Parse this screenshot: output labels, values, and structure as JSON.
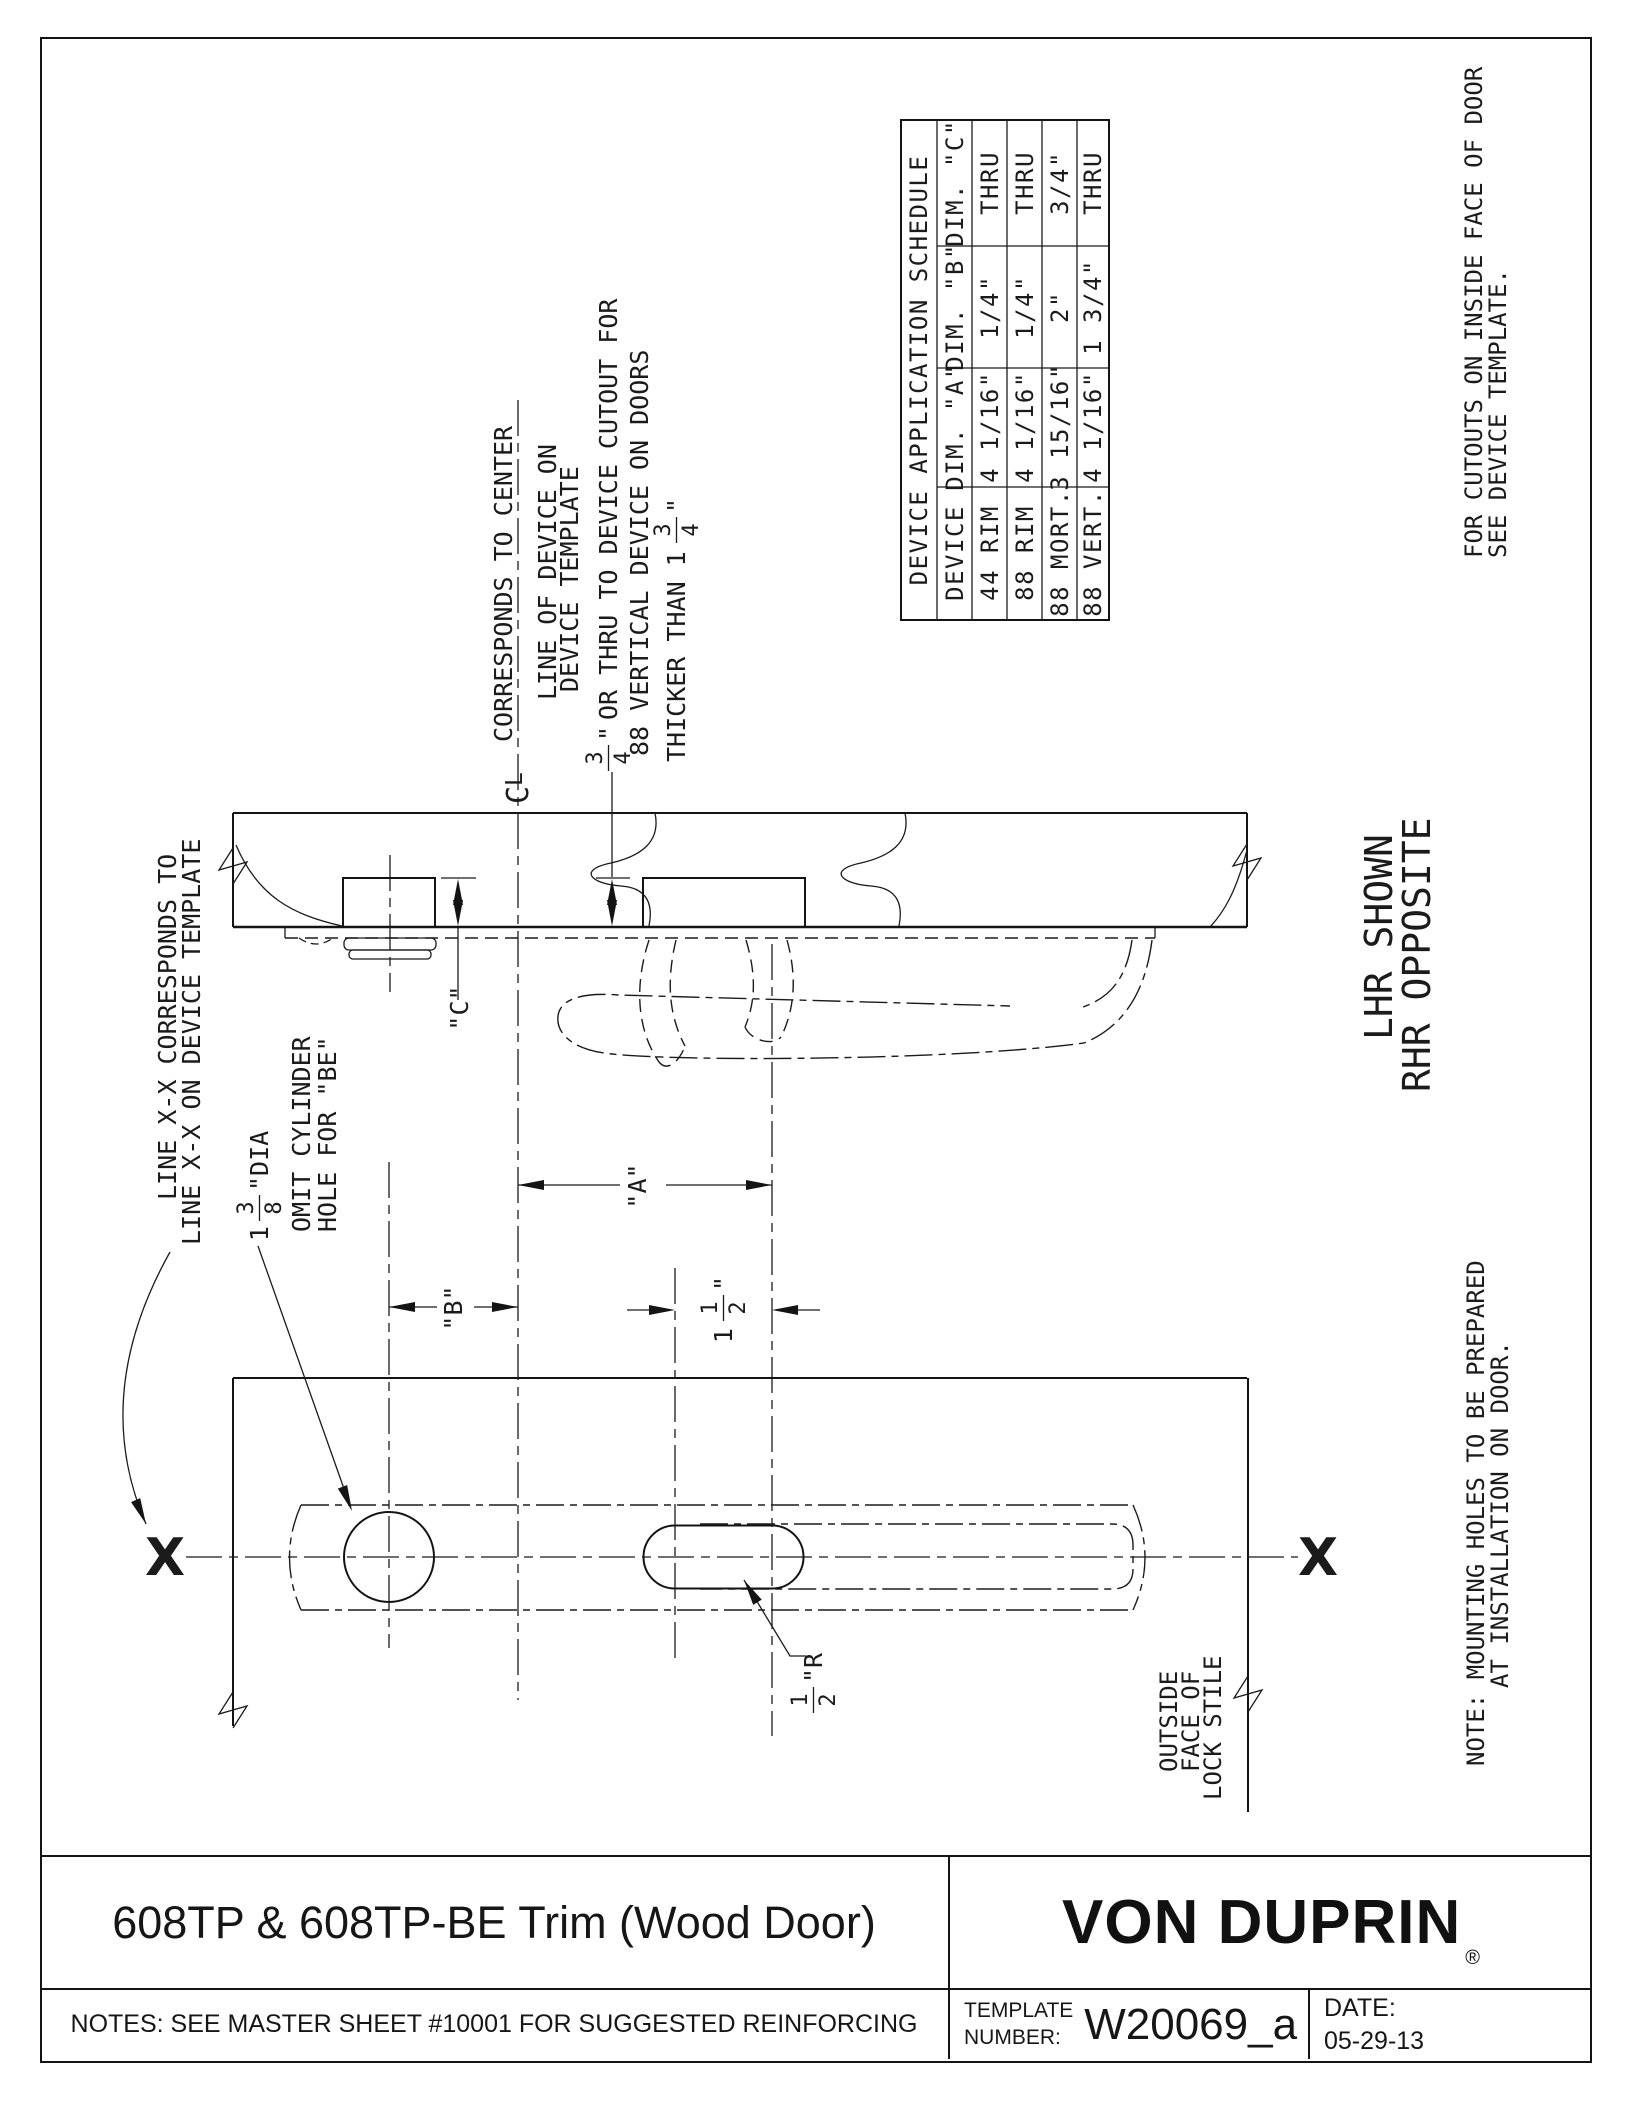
{
  "doc": {
    "title": "608TP & 608TP-BE Trim (Wood Door)",
    "brand": "VON DUPRIN",
    "reg": "®",
    "notes": "NOTES: SEE MASTER SHEET #10001 FOR SUGGESTED REINFORCING",
    "template_label1": "TEMPLATE",
    "template_label2": "NUMBER:",
    "template_number": "W20069_a",
    "date_label": "DATE:",
    "date": "05-29-13"
  },
  "schedule": {
    "title": "DEVICE APPLICATION SCHEDULE",
    "col_device": "DEVICE",
    "col_a": "DIM. \"A\"",
    "col_b": "DIM. \"B\"",
    "col_c": "DIM. \"C\"",
    "rows": [
      {
        "device": "44 RIM",
        "a": "4 1/16\"",
        "b": "1/4\"",
        "c": "THRU"
      },
      {
        "device": "88 RIM",
        "a": "4 1/16\"",
        "b": "1/4\"",
        "c": "THRU"
      },
      {
        "device": "88 MORT.",
        "a": "3 15/16\"",
        "b": "2\"",
        "c": "3/4\""
      },
      {
        "device": "88 VERT.",
        "a": "4 1/16\"",
        "b": "1 3/4\"",
        "c": "THRU"
      }
    ]
  },
  "notes": {
    "center1": "CORRESPONDS TO CENTER",
    "center2": "LINE OF DEVICE ON",
    "center3": "DEVICE TEMPLATE",
    "cutout1_rest": "OR THRU TO DEVICE CUTOUT FOR",
    "cutout2": "88 VERTICAL DEVICE ON DOORS",
    "cutout3_lead": "THICKER THAN 1",
    "linexx1": "LINE X-X CORRESPONDS TO",
    "linexx2": "LINE X-X ON DEVICE TEMPLATE",
    "cyl2": "OMIT CYLINDER",
    "cyl3": "HOLE FOR \"BE\"",
    "outside1": "OUTSIDE",
    "outside2": "FACE OF",
    "outside3": "LOCK STILE",
    "hand1": "LHR SHOWN",
    "hand2": "RHR OPPOSITE",
    "inside1": "FOR CUTOUTS ON INSIDE FACE OF DOOR",
    "inside2": "SEE DEVICE TEMPLATE.",
    "mount1": "NOTE:  MOUNTING HOLES TO BE PREPARED",
    "mount2": "AT INSTALLATION ON DOOR."
  },
  "dims": {
    "a": "\"A\"",
    "b": "\"B\"",
    "c": "\"C\"",
    "x": "X",
    "cl_c": "C",
    "cl_l": "L",
    "f34": {
      "n": "3",
      "d": "4",
      "suf": "\""
    },
    "f34b": {
      "n": "3",
      "d": "4",
      "suf": "\""
    },
    "f138": {
      "lead": "1",
      "n": "3",
      "d": "8",
      "suf": "\"DIA"
    },
    "f112": {
      "lead": "1",
      "n": "1",
      "d": "2",
      "suf": "\""
    },
    "f12r": {
      "n": "1",
      "d": "2",
      "suf": "\"R"
    }
  }
}
